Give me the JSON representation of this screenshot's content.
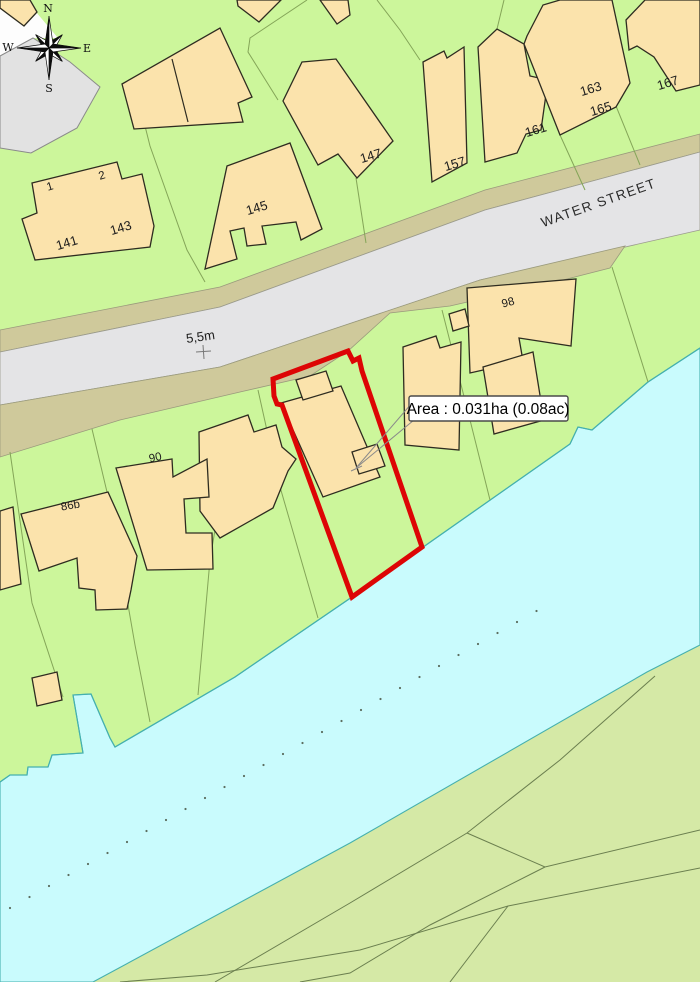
{
  "street": {
    "name": "WATER STREET"
  },
  "road_width": {
    "text": "5,5m"
  },
  "annotation": {
    "area_label": "Area : 0.031ha (0.08ac)"
  },
  "compass": {
    "north": "N",
    "east": "E",
    "south": "S",
    "west": "W"
  },
  "house_numbers": {
    "n1": "1",
    "n2": "2",
    "h141": "141",
    "h143": "143",
    "h145": "145",
    "h147": "147",
    "h157": "157",
    "h161": "161",
    "h163": "163",
    "h165": "165",
    "h167": "167",
    "h98": "98",
    "h90": "90",
    "h86b": "86b"
  },
  "plot": {
    "area_ha": "0.031",
    "area_ac": "0.08"
  },
  "colors": {
    "parcel_green": "#ccf69b",
    "far_bank_green": "#d5e9a6",
    "water": "#c9fbfd",
    "building": "#fbe3ac",
    "road": "#e4e4e6",
    "verge": "#cfc99b",
    "gray_area": "#e2e2e2",
    "plot_outline": "#dd0505",
    "bank_line": "#45b0ae"
  }
}
